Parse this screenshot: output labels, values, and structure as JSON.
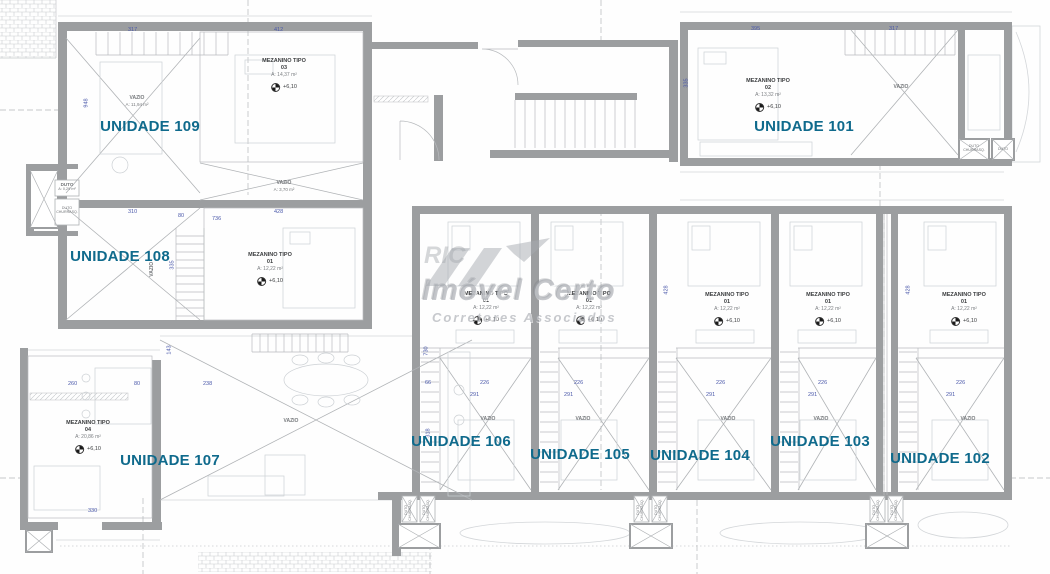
{
  "units": [
    {
      "label": "UNIDADE 109"
    },
    {
      "label": "UNIDADE 108"
    },
    {
      "label": "UNIDADE 107"
    },
    {
      "label": "UNIDADE 106"
    },
    {
      "label": "UNIDADE 105"
    },
    {
      "label": "UNIDADE 104"
    },
    {
      "label": "UNIDADE 103"
    },
    {
      "label": "UNIDADE 102"
    },
    {
      "label": "UNIDADE 101"
    }
  ],
  "mezzanines": [
    {
      "title": "MEZANINO TIPO",
      "num": "03",
      "area": "A: 14,37 m²",
      "level": "+6,10"
    },
    {
      "title": "MEZANINO TIPO",
      "num": "01",
      "area": "A: 12,22 m²",
      "level": "+6,10"
    },
    {
      "title": "MEZANINO TIPO",
      "num": "02",
      "area": "A: 13,32 m²",
      "level": "+6,10"
    },
    {
      "title": "MEZANINO TIPO",
      "num": "04",
      "area": "A: 20,86 m²",
      "level": "+6,10"
    },
    {
      "title": "MEZANINO TIPO",
      "num": "01",
      "area": "A: 12,22 m²",
      "level": "+6,10"
    },
    {
      "title": "MEZANINO TIPO",
      "num": "01",
      "area": "A: 12,22 m²",
      "level": "+6,10"
    },
    {
      "title": "MEZANINO TIPO",
      "num": "01",
      "area": "A: 12,22 m²",
      "level": "+6,10"
    },
    {
      "title": "MEZANINO TIPO",
      "num": "01",
      "area": "A: 12,22 m²",
      "level": "+6,10"
    },
    {
      "title": "MEZANINO TIPO",
      "num": "01",
      "area": "A: 12,22 m²",
      "level": "+6,10"
    }
  ],
  "voids": [
    {
      "label": "VAZIO",
      "area": "A: 11,94 m²"
    },
    {
      "label": "VAZIO",
      "area": "A: 3,70 m²"
    },
    {
      "label": "VAZIO"
    },
    {
      "label": "VAZIO"
    },
    {
      "label": "VAZIO"
    },
    {
      "label": "VAZIO"
    },
    {
      "label": "VAZIO"
    },
    {
      "label": "VAZIO"
    },
    {
      "label": "VAZIO"
    },
    {
      "label": "VAZIO"
    }
  ],
  "ducts": {
    "duto": "DUTO",
    "duto_area": "A: 0,29 m²",
    "churrasq_l1": "DUTO",
    "churrasq_l2": "CHURRASQ.",
    "churrasq": "DUTO CHURRASQ."
  },
  "watermark": {
    "prefix": "RIC",
    "name": "Imóvel Certo",
    "subtitle": "Corretores Associados"
  },
  "dims": [
    {
      "v": "317"
    },
    {
      "v": "412"
    },
    {
      "v": "948"
    },
    {
      "v": "310"
    },
    {
      "v": "80"
    },
    {
      "v": "428"
    },
    {
      "v": "736"
    },
    {
      "v": "335"
    },
    {
      "v": "395"
    },
    {
      "v": "317"
    },
    {
      "v": "335"
    },
    {
      "v": "260"
    },
    {
      "v": "80"
    },
    {
      "v": "238"
    },
    {
      "v": "143"
    },
    {
      "v": "330"
    },
    {
      "v": "226"
    },
    {
      "v": "291"
    },
    {
      "v": "66"
    },
    {
      "v": "730"
    },
    {
      "v": "318"
    },
    {
      "v": "226"
    },
    {
      "v": "291"
    },
    {
      "v": "226"
    },
    {
      "v": "291"
    },
    {
      "v": "226"
    },
    {
      "v": "291"
    },
    {
      "v": "226"
    },
    {
      "v": "291"
    },
    {
      "v": "428"
    },
    {
      "v": "428"
    }
  ]
}
